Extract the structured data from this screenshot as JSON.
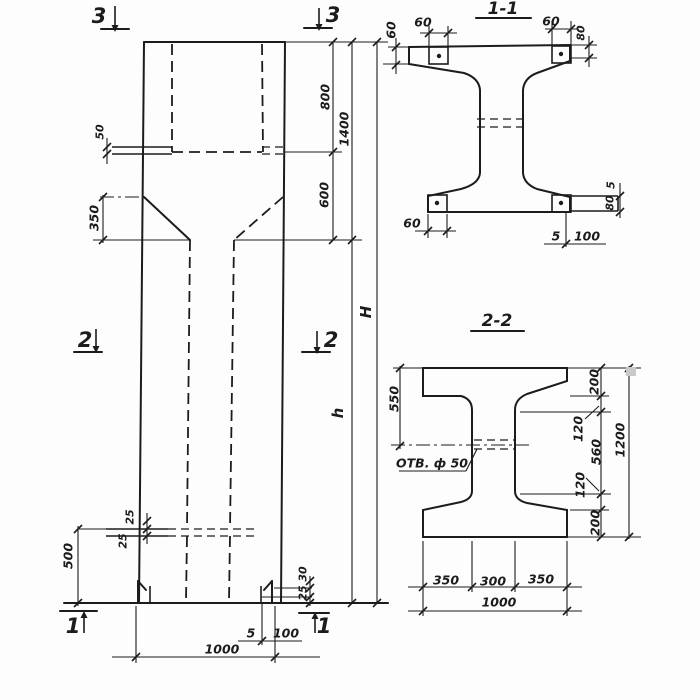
{
  "style": {
    "ink": "#1c1c1c",
    "paper": "#fdfdfd",
    "artifact_gray": "#c9c9c9"
  },
  "elevation": {
    "markers": {
      "top_left": "3",
      "top_right": "3",
      "mid_left": "2",
      "mid_right": "2",
      "bottom_left": "1",
      "bottom_right": "1"
    },
    "dims": {
      "console_plate": "50",
      "taper": "350",
      "top_to_console": "800",
      "console_to_shaft": "600",
      "head_total": "1400",
      "overall_height": "H",
      "shaft_height": "h",
      "groove_top": "25",
      "groove_bottom": "25",
      "base_zone": "500",
      "foot_upper": "30",
      "foot_lower": "25",
      "base_plate_thk": "5",
      "base_plate_len": "100",
      "width": "1000"
    }
  },
  "section_1_1": {
    "title": "1-1",
    "dims": {
      "plate_top_left_w": "60",
      "plate_top_left_h": "60",
      "plate_top_right_w": "60",
      "flange_top_right": "80",
      "plate_bottom_left_w": "60",
      "plate_right_gap": "5",
      "plate_right_h": "80",
      "plate_bottom_thk": "5",
      "plate_bottom_len": "100"
    }
  },
  "section_2_2": {
    "title": "2-2",
    "hole_label": "ОТВ. ф 50",
    "dims": {
      "top_to_hole": "550",
      "flange_top": "200",
      "haunch_top": "120",
      "web_clear": "560",
      "haunch_bottom": "120",
      "flange_bottom": "200",
      "height": "1200",
      "bottom_left": "350",
      "bottom_mid": "300",
      "bottom_right": "350",
      "width": "1000"
    }
  }
}
